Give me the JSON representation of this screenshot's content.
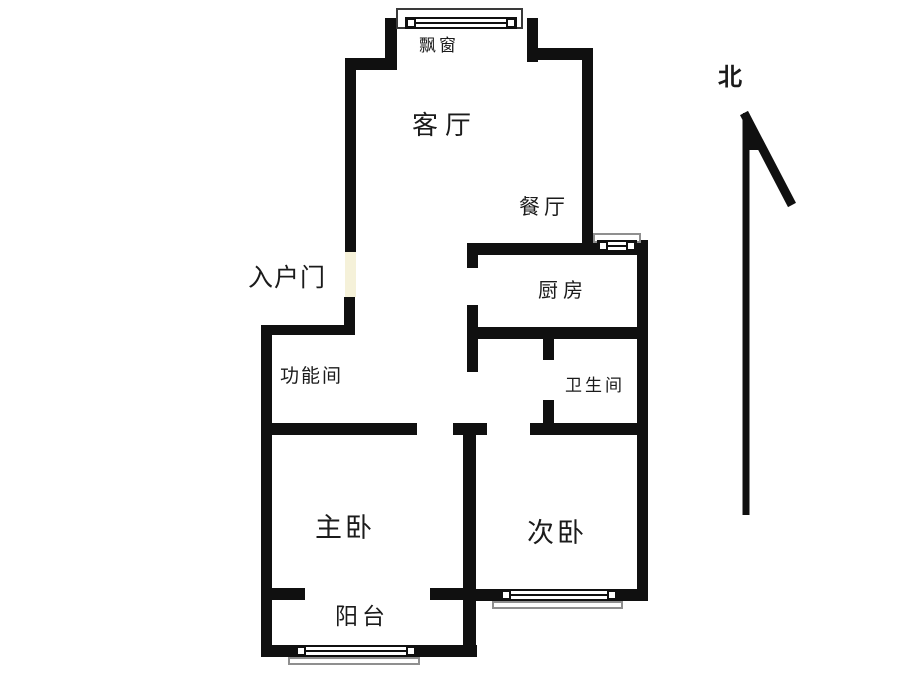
{
  "page": {
    "type": "apartment-floor-plan"
  },
  "rooms": {
    "bay_window": "飘窗",
    "living_room": "客厅",
    "dining_room": "餐厅",
    "entrance": "入户门",
    "kitchen": "厨房",
    "utility_room": "功能间",
    "bathroom": "卫生间",
    "master_bedroom": "主卧",
    "second_bedroom": "次卧",
    "balcony": "阳台"
  },
  "compass": {
    "north_label": "北"
  },
  "colors": {
    "wall": "#101010",
    "entrance_door_gap": "#F5F1D9",
    "window_sill_border": "#8f8f8f",
    "label_text": "#1b1b1b",
    "background": "#FFFFFF"
  }
}
